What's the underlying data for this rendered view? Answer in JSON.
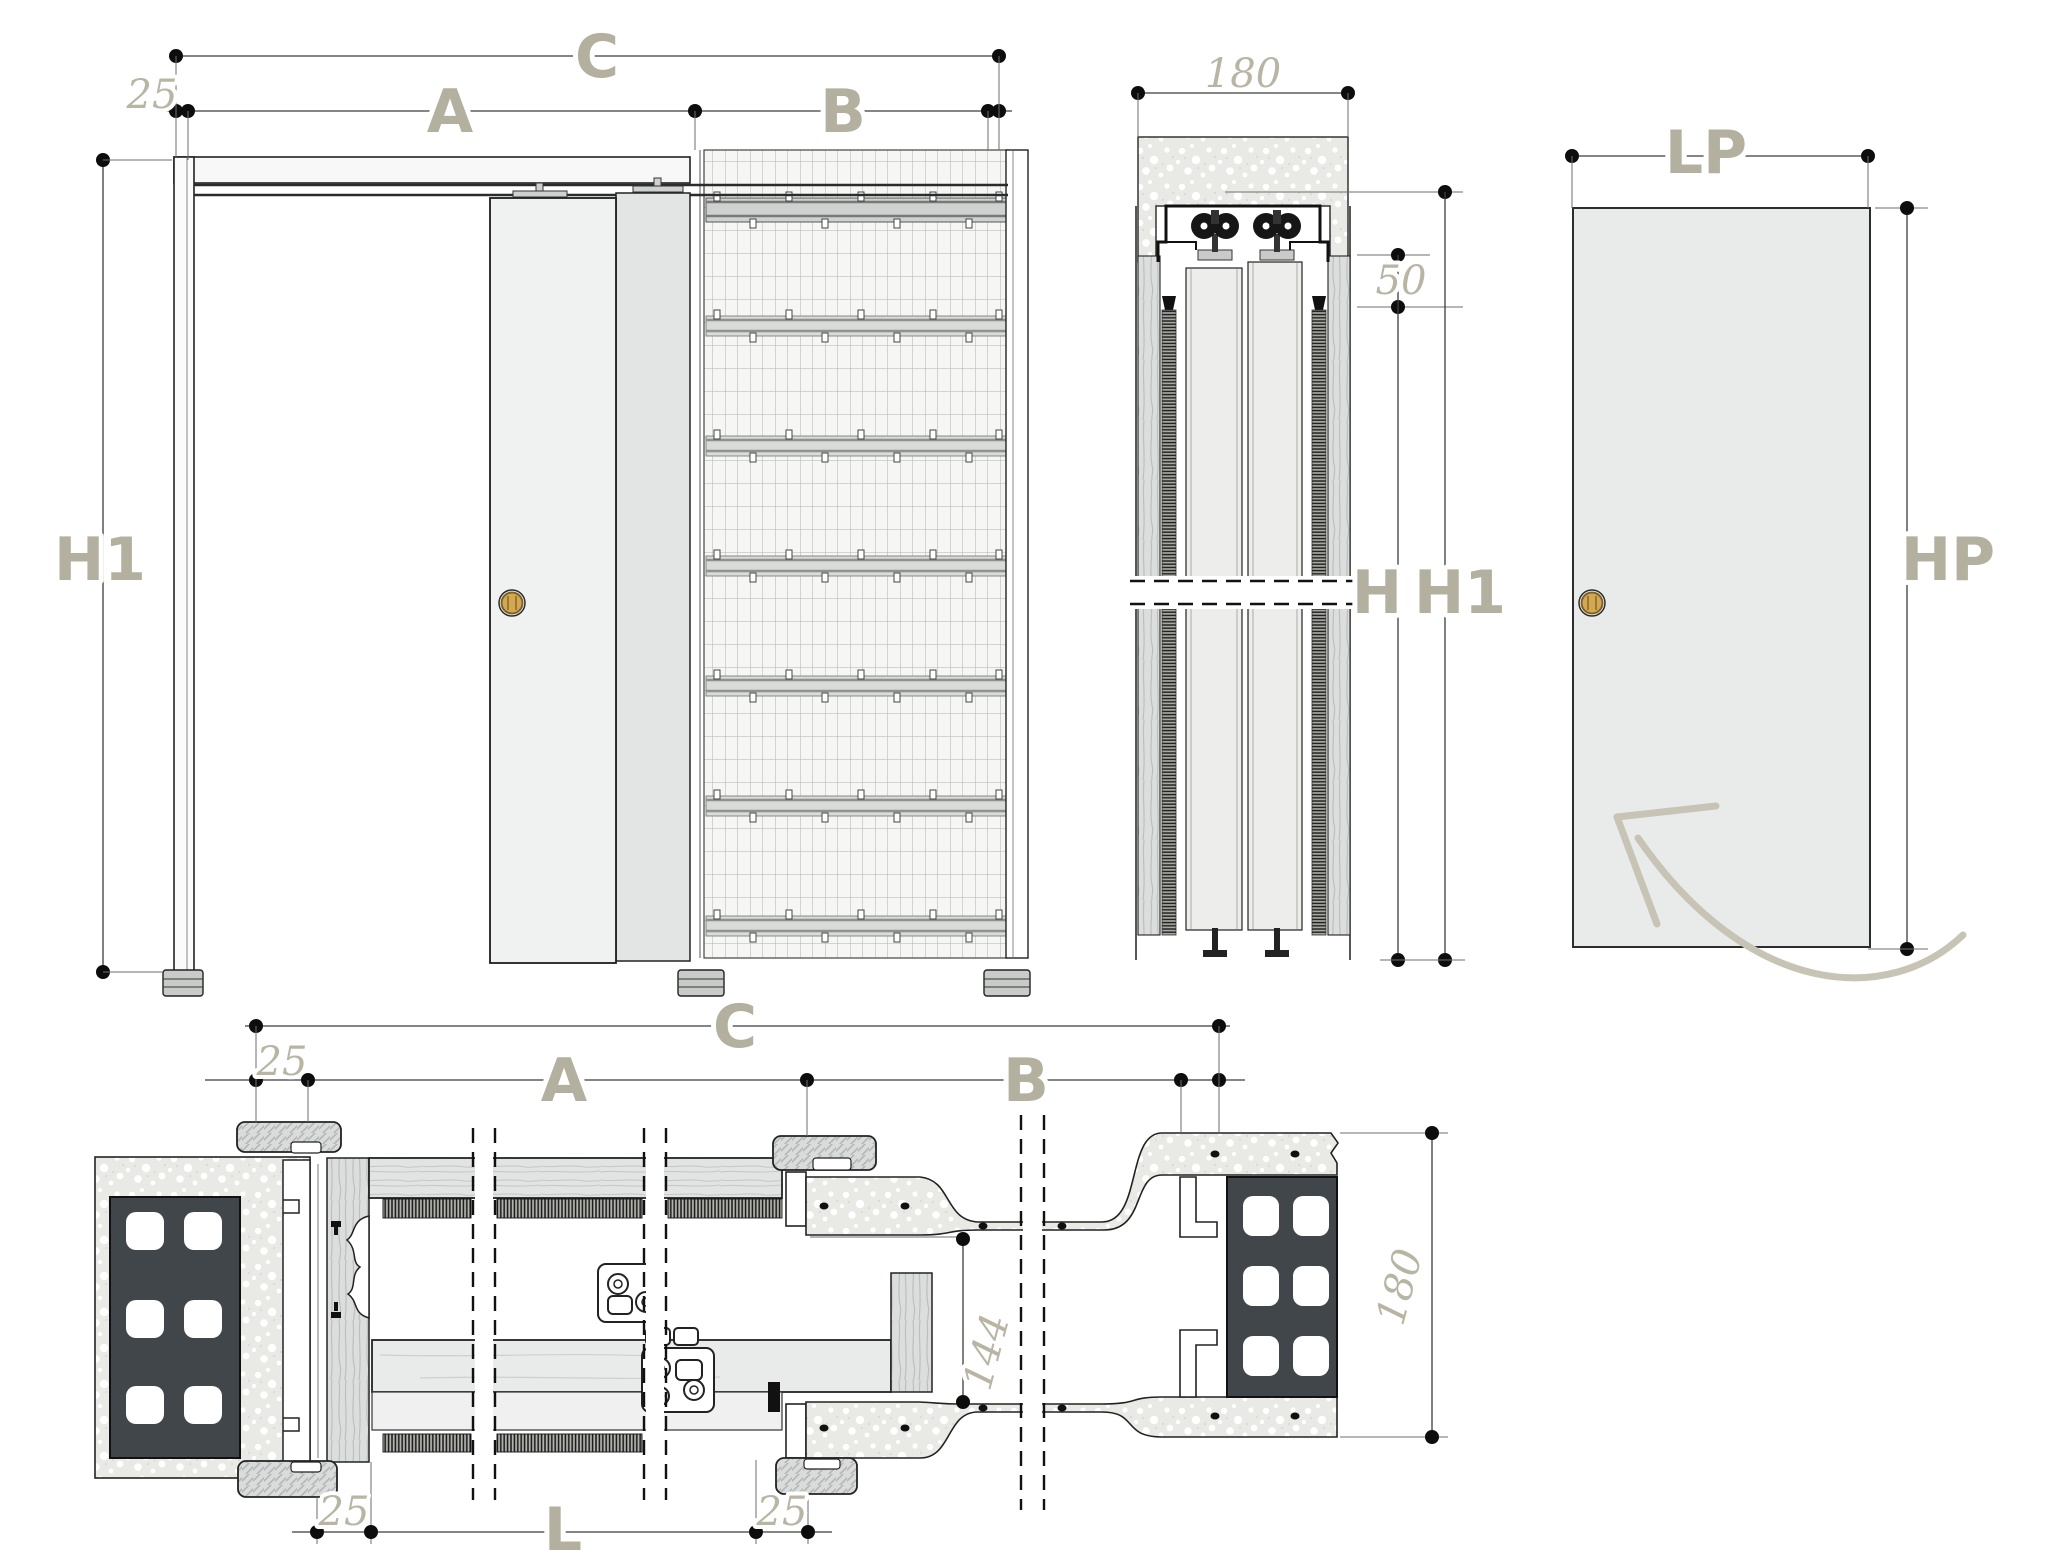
{
  "drawing_type": "pocket-sliding-door-technical-drawing",
  "colors": {
    "label": "#b4b0a0",
    "thin_number": "#b9b5a5",
    "line": "#1e1e1e",
    "dimension_line": "#3c3c3c",
    "wood": "#dcdedd",
    "plaster_speckle": "#e9e9e5",
    "brick": "#41464a",
    "door_panel": "#e9ebea",
    "handle_gold": "#d2a850",
    "arrow": "#c7c4b5"
  },
  "elevation": {
    "c": "C",
    "a": "A",
    "b": "B",
    "offset": "25",
    "h1": "H1"
  },
  "section": {
    "width": "180",
    "gap": "50",
    "h": "H",
    "h1": "H1"
  },
  "panel": {
    "lp": "LP",
    "hp": "HP"
  },
  "plan": {
    "c": "C",
    "a": "A",
    "b": "B",
    "offset": "25",
    "pocket": "144",
    "wall": "180",
    "l": "L",
    "l_left": "25",
    "l_right": "25"
  }
}
